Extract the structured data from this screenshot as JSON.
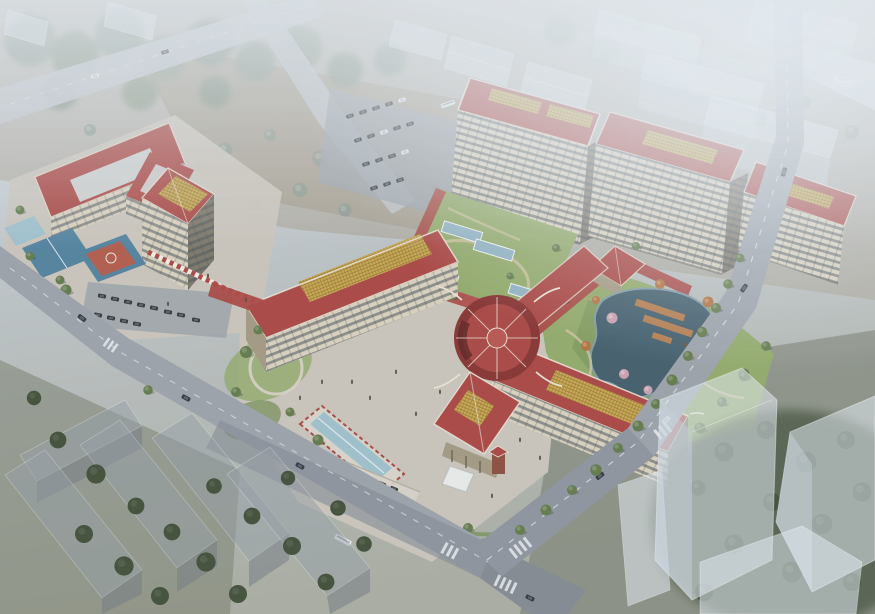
{
  "scene": {
    "type": "aerial-architectural-rendering",
    "subject": "hospital-campus-birdseye-with-chinese-style-red-roofs",
    "regions": [
      "hazy-forest-northwest",
      "north-field-with-trees",
      "perimeter-roads",
      "left-inpatient-complex",
      "sports-courts",
      "central-cross-building-with-rotunda",
      "entrance-plaza-fountain",
      "north-highrise-tower",
      "green-roof-terrace",
      "east-highrise-tower",
      "east-slab-building",
      "landscape-pond-garden",
      "ghost-massing-neighborhood",
      "parking-lots",
      "street-trees"
    ]
  },
  "palette": {
    "sky-haze": "#ccd3d8",
    "ground-field": "#a49b8b",
    "ground-dark": "#8e8679",
    "road-light": "#bcc1c6",
    "road-mid": "#9aa0a7",
    "road-dark": "#81878f",
    "lane-white": "#e8ebee",
    "paving": "#c9c3b8",
    "paving-light": "#d8d2c7",
    "roof-red": "#a8433f",
    "roof-red-light": "#b5524b",
    "roof-red-dark": "#85302e",
    "ridge-white": "#e9e1d1",
    "gold-panel": "#c9a54b",
    "gold-line": "#876c2c",
    "facade": "#d9d0bc",
    "facade-shadow": "#a2977f",
    "facade-dark": "#7a7466",
    "window-dark": "#39434d",
    "skylight": "#cfd6d4",
    "glass-blue": "#8fb0c0",
    "water-pond": "#3f5a68",
    "water-pool": "#9dbfca",
    "lawn": "#90a866",
    "lawn-dark": "#6f8a4e",
    "tree-green": "#5f7747",
    "tree-dark": "#3d4b34",
    "tree-hazy": "#8b988c",
    "tree-autumn": "#b06f3d",
    "tree-pink": "#c99fae",
    "court-red": "#b05848",
    "court-blue": "#4f7f9b",
    "deck-wood": "#b27a4a",
    "wall-dark": "#4e524d",
    "ghost-top": "rgba(226,233,240,0.55)",
    "ghost-face": "rgba(198,207,216,0.50)",
    "ghost-dark": "rgba(148,156,164,0.50)",
    "car-dark": "#2d3236",
    "car-white": "#e8eaec",
    "people": "#55493f"
  }
}
